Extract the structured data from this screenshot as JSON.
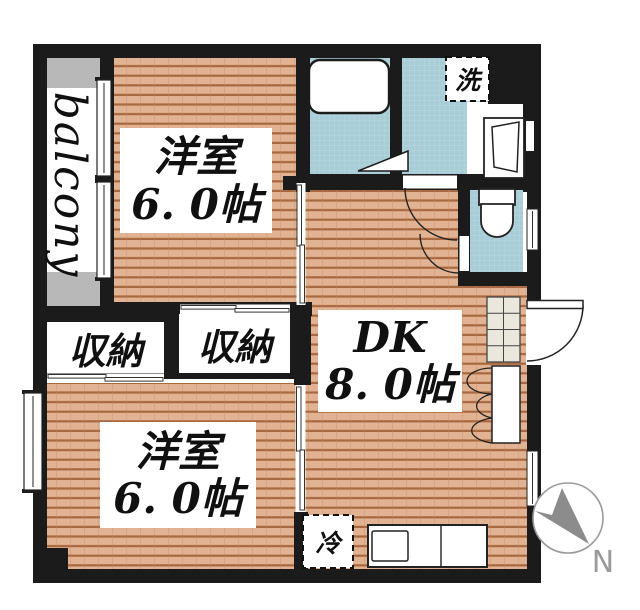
{
  "floorplan": {
    "balcony": {
      "label": "balcony"
    },
    "room1": {
      "name": "洋室",
      "size": "6. 0帖"
    },
    "room2": {
      "name": "洋室",
      "size": "6. 0帖"
    },
    "dk": {
      "name": "DK",
      "size": "8. 0帖"
    },
    "closet_left": {
      "label": "収納"
    },
    "closet_right": {
      "label": "収納"
    },
    "washer": {
      "label": "洗"
    },
    "fridge": {
      "label": "冷"
    },
    "compass": {
      "north_label": "N"
    },
    "colors": {
      "wall": "#1b1b1b",
      "wood_floor": "#e2b392",
      "wood_plank_line": "#a8683f",
      "wet_area": "#a8cdd7",
      "wet_grid_line": "#bcdae1",
      "balcony_cap_gray": "#b8b8b8",
      "fixture_outline": "#222222",
      "shoe_cabinet_fill": "#eae7dc",
      "compass_gray": "#8c8c8c"
    }
  }
}
